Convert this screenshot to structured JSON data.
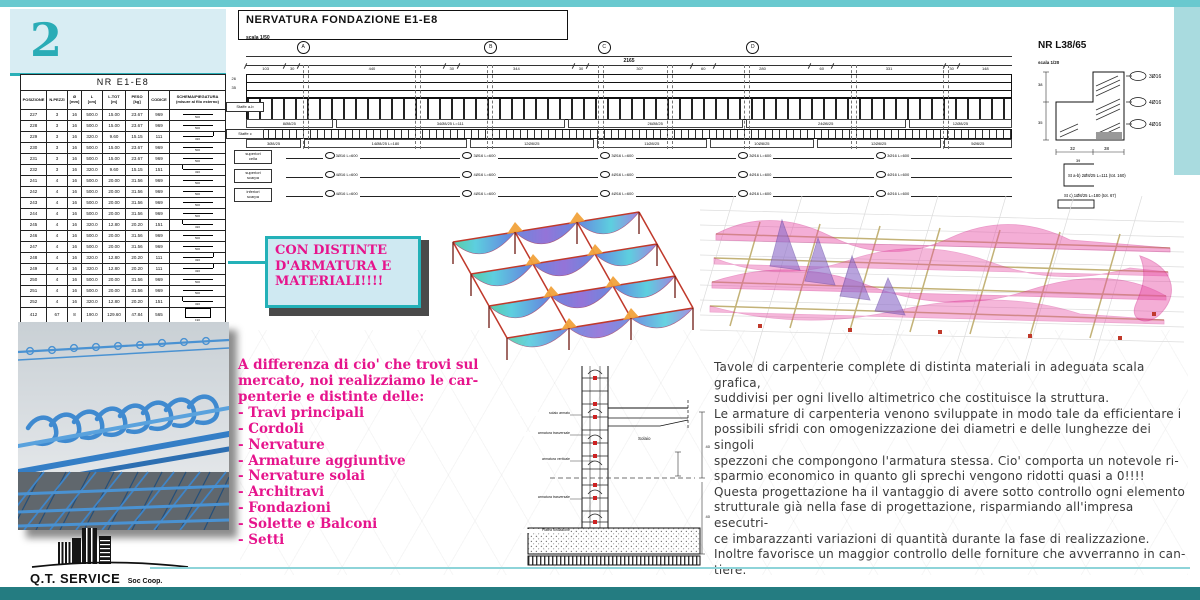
{
  "page_number": "2",
  "colors": {
    "teal": "#2ab0b8",
    "magenta": "#e6148c",
    "bar_top": "#69c9cf",
    "bar_bottom": "#247c81",
    "panel": "#d8edf3"
  },
  "table": {
    "title": "NR E1-E8",
    "headers": [
      "POSIZIONE",
      "N.PEZZI",
      "Ø\n[mm]",
      "L\n[cm]",
      "L.TOT\n[m]",
      "PESO\n[kg]",
      "CODICE",
      "SCHEMA/PIEGATURA\n(misure al filo esterno)"
    ],
    "rows": [
      {
        "c": [
          "227",
          "3",
          "16",
          "500.0",
          "15.00",
          "23.67",
          "969"
        ],
        "schema": "line",
        "dim": "500"
      },
      {
        "c": [
          "228",
          "3",
          "16",
          "500.0",
          "15.00",
          "23.67",
          "969"
        ],
        "schema": "line",
        "dim": "500"
      },
      {
        "c": [
          "229",
          "3",
          "16",
          "320.0",
          "9.60",
          "15.15",
          "111"
        ],
        "schema": "hook-r",
        "dim": "320"
      },
      {
        "c": [
          "230",
          "3",
          "16",
          "500.0",
          "15.00",
          "23.67",
          "969"
        ],
        "schema": "line",
        "dim": "500"
      },
      {
        "c": [
          "231",
          "3",
          "16",
          "500.0",
          "15.00",
          "23.67",
          "969"
        ],
        "schema": "line",
        "dim": "500"
      },
      {
        "c": [
          "232",
          "3",
          "16",
          "320.0",
          "9.60",
          "15.15",
          "151"
        ],
        "schema": "hook-l",
        "dim": "320"
      },
      {
        "c": [
          "241",
          "4",
          "16",
          "500.0",
          "20.00",
          "31.56",
          "969"
        ],
        "schema": "line",
        "dim": "500"
      },
      {
        "c": [
          "242",
          "4",
          "16",
          "500.0",
          "20.00",
          "31.56",
          "969"
        ],
        "schema": "line",
        "dim": "500"
      },
      {
        "c": [
          "243",
          "4",
          "16",
          "500.0",
          "20.00",
          "31.56",
          "969"
        ],
        "schema": "line",
        "dim": "500"
      },
      {
        "c": [
          "244",
          "4",
          "16",
          "500.0",
          "20.00",
          "31.56",
          "969"
        ],
        "schema": "line",
        "dim": "500"
      },
      {
        "c": [
          "245",
          "4",
          "16",
          "320.0",
          "12.80",
          "20.20",
          "151"
        ],
        "schema": "hook-l",
        "dim": "320"
      },
      {
        "c": [
          "246",
          "4",
          "16",
          "500.0",
          "20.00",
          "31.56",
          "969"
        ],
        "schema": "line",
        "dim": "500"
      },
      {
        "c": [
          "247",
          "4",
          "16",
          "500.0",
          "20.00",
          "31.56",
          "969"
        ],
        "schema": "line",
        "dim": "500"
      },
      {
        "c": [
          "248",
          "4",
          "16",
          "320.0",
          "12.80",
          "20.20",
          "111"
        ],
        "schema": "hook-r",
        "dim": "320"
      },
      {
        "c": [
          "249",
          "4",
          "16",
          "320.0",
          "12.80",
          "20.20",
          "111"
        ],
        "schema": "hook-r",
        "dim": "320"
      },
      {
        "c": [
          "250",
          "4",
          "16",
          "500.0",
          "20.00",
          "31.56",
          "969"
        ],
        "schema": "line",
        "dim": "500"
      },
      {
        "c": [
          "251",
          "4",
          "16",
          "500.0",
          "20.00",
          "31.56",
          "969"
        ],
        "schema": "line",
        "dim": "500"
      },
      {
        "c": [
          "252",
          "4",
          "16",
          "320.0",
          "12.80",
          "20.20",
          "151"
        ],
        "schema": "hook-l",
        "dim": "320"
      },
      {
        "c": [
          "412",
          "67",
          "8",
          "190.0",
          "129.60",
          "47.84",
          "565"
        ],
        "schema": "rect",
        "dim": "190"
      },
      {
        "c": [
          "413",
          "160",
          "8",
          "111.0",
          "177.60",
          "70.15",
          "212"
        ],
        "schema": "u",
        "dim": "111"
      }
    ],
    "total_label": "PESO TOTALE",
    "total_value": "578.05"
  },
  "drawing": {
    "title": "NERVATURA FONDAZIONE E1-E8",
    "scale": "scala 1/50",
    "grid_bubbles": [
      "A",
      "B",
      "C",
      "D"
    ],
    "total_dim": "2165",
    "dims": [
      "103",
      "30",
      "440",
      "30",
      "344",
      "30",
      "307",
      "60",
      "280",
      "60",
      "331",
      "30",
      "148"
    ],
    "left_dims": "26\n35",
    "staffe_ab_name": "Staffe a-b",
    "staffe_c_name": "Staffe c",
    "staffe_ab_labels": [
      "8Ø8/25",
      "34Ø8/25 L=111",
      "26Ø8/25",
      "24Ø8/25",
      "12Ø8/25"
    ],
    "staffe_c_labels": [
      "3Ø8/25",
      "14Ø8/25 L=180",
      "12Ø8/25",
      "11Ø8/25",
      "10Ø8/25",
      "12Ø8/25",
      "5Ø8/25"
    ],
    "bar_rows": [
      {
        "label": "superiori\ncella",
        "chip": "3Ø16 L=600"
      },
      {
        "label": "superiori\nscarpa",
        "chip": "4Ø16 L=600"
      },
      {
        "label": "inferiori\nscarpa",
        "chip": "4Ø16 L=600"
      }
    ]
  },
  "detail": {
    "title": "NR L38/65",
    "scale": "scala 1/20",
    "bars": [
      "3Ø16",
      "4Ø16",
      "4Ø16"
    ],
    "width_dims": [
      "32",
      "38"
    ],
    "height_dims": [
      "38",
      "35"
    ],
    "st_ab_dim": "39",
    "st_ab": "St a-b)  2Ø8/25 L=111 (tot. 160)",
    "st_c": "St c)  1Ø8/25 L=180 (tot. 67)"
  },
  "callout": {
    "text": "CON DISTINTE\nD'ARMATURA E\nMATERIALI!!!!"
  },
  "features": {
    "intro": "A differenza di cio' che trovi sul\nmercato, noi realizziamo le car-\npenterie e distinte delle:",
    "items": [
      "Travi principali",
      "Cordoli",
      "Nervature",
      "Armature aggiuntive",
      "Nervature solai",
      "Architravi",
      "Fondazioni",
      "Solette e Balconi",
      "Setti"
    ]
  },
  "section": {
    "labels": [
      "solaio armato",
      "armatura trasversale",
      "armatura verticale",
      "armatura trasversale",
      "Platea fondazione"
    ],
    "slab_label": "Solaio",
    "right_dims": [
      "40",
      "40"
    ]
  },
  "body_text": "Tavole di carpenterie complete di distinta materiali in adeguata scala grafica,\nsuddivisi per ogni livello altimetrico che costituisce la struttura.\nLe armature di carpenteria venono sviluppate in modo tale da efficientare i\npossibili sfridi con omogenizzazione dei diametri e delle lunghezze dei singoli\nspezzoni che compongono l'armatura stessa. Cio' comporta un notevole ri-\nsparmio economico in quanto gli sprechi vengono ridotti quasi a 0!!!!\nQuesta progettazione ha il vantaggio di avere sotto controllo ogni elemento\nstrutturale già nella fase di progettazione, risparmiando all'impresa esecutri-\nce imbarazzanti variazioni di quantità durante la fase di realizzazione.\nInoltre favorisce un maggior controllo delle forniture che avverranno in can-\ntiere.",
  "footer": {
    "company": "Q.T. SERVICE",
    "suffix": "Soc Coop."
  }
}
